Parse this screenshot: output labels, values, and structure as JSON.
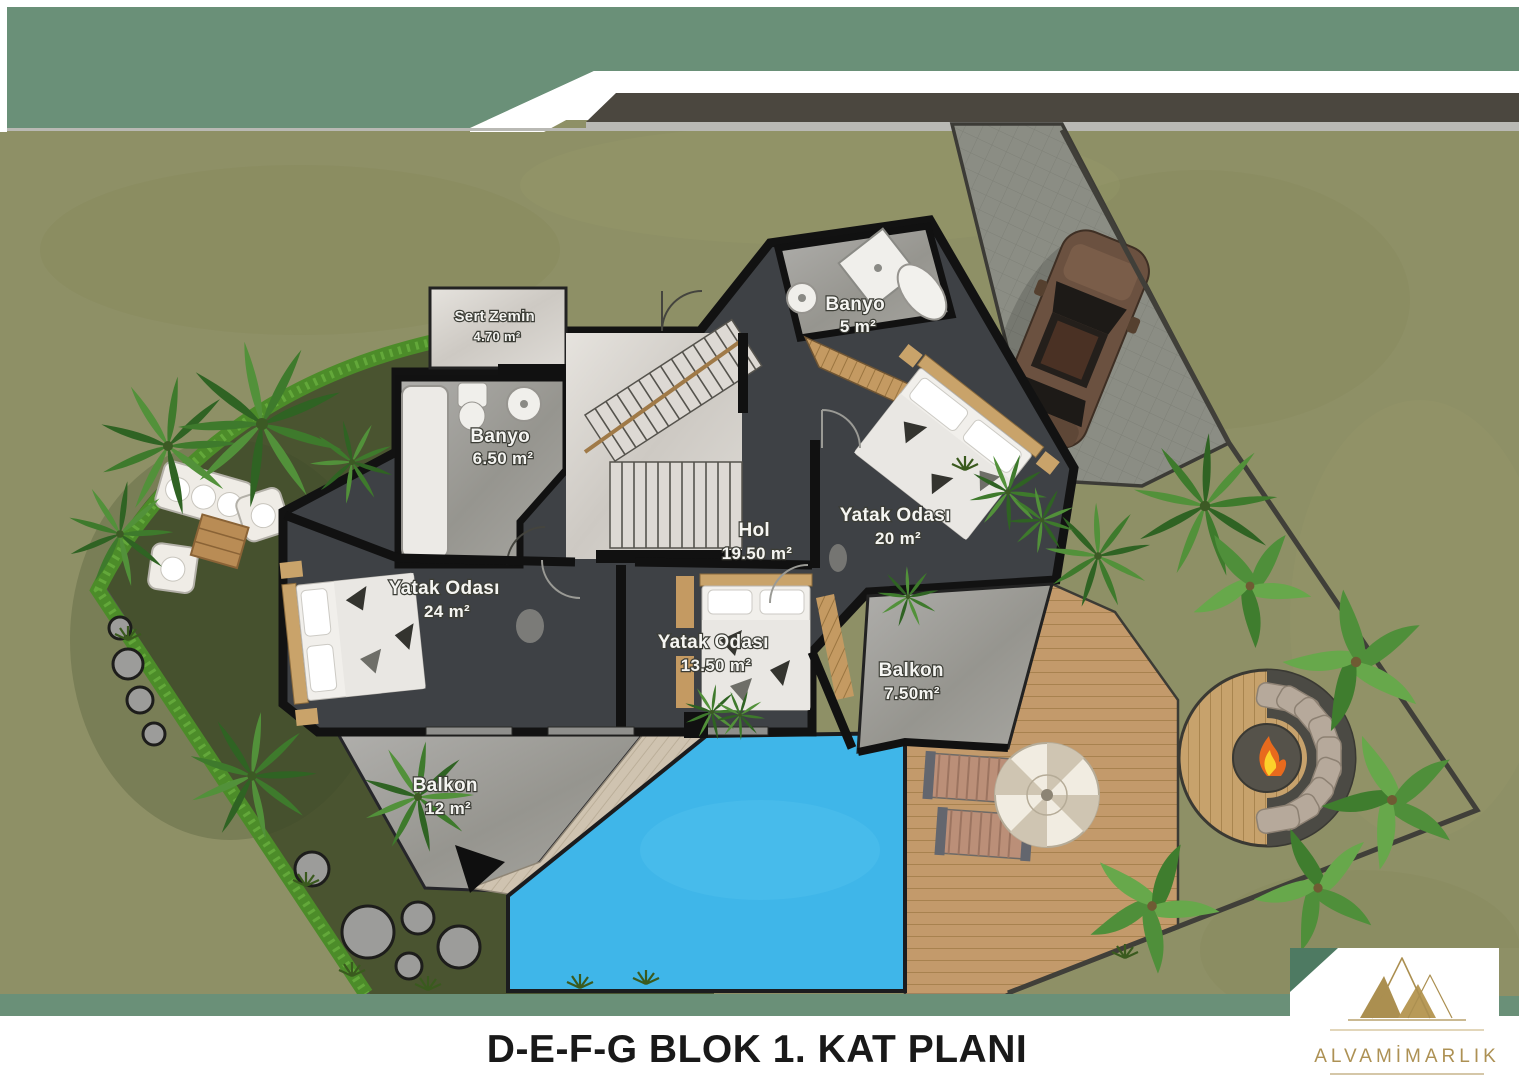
{
  "title": "D-E-F-G BLOK 1. KAT PLANI",
  "brand": {
    "name": "ALVAMİMARLIK",
    "logo": "alva-mountain-logo"
  },
  "plan": {
    "block": "D-E-F-G",
    "floor_label": "1. KAT PLANI",
    "rooms": [
      {
        "id": "sert-zemin",
        "name": "Sert Zemin",
        "area": "4.70 m²"
      },
      {
        "id": "banyo-buyuk",
        "name": "Banyo",
        "area": "6.50 m²"
      },
      {
        "id": "banyo-kucuk",
        "name": "Banyo",
        "area": "5 m²"
      },
      {
        "id": "hol",
        "name": "Hol",
        "area": "19.50 m²"
      },
      {
        "id": "yatak-odasi-24",
        "name": "Yatak Odası",
        "area": "24 m²"
      },
      {
        "id": "yatak-odasi-13",
        "name": "Yatak Odası",
        "area": "13.50 m²"
      },
      {
        "id": "yatak-odasi-20",
        "name": "Yatak Odası",
        "area": "20 m²"
      },
      {
        "id": "balkon-12",
        "name": "Balkon",
        "area": "12 m²"
      },
      {
        "id": "balkon-750",
        "name": "Balkon",
        "area": "7.50m²"
      }
    ],
    "outdoor_features": [
      "swimming-pool",
      "wood-deck",
      "sun-loungers",
      "patio-umbrella",
      "fire-pit-lounge",
      "garden-sofa-set",
      "stepping-stones",
      "driveway",
      "parked-car",
      "palm-trees",
      "hedge",
      "lawn"
    ]
  },
  "colors": {
    "band_green": "#6a9078",
    "accent_green_dark": "#4e7a62",
    "road": "#4b473f",
    "grass": "#8e9066",
    "lawn_dark": "#4a5430",
    "hedge": "#4c8c29",
    "pool": "#3fb6e9",
    "house_floor": "#3e4145",
    "wall": "#121212",
    "marble_light": "#d8d5d0",
    "marble_gray": "#9e9d99",
    "wood": "#c49a62",
    "deck_wood": "#c39a6b",
    "logo_gold": "#ad9154"
  }
}
